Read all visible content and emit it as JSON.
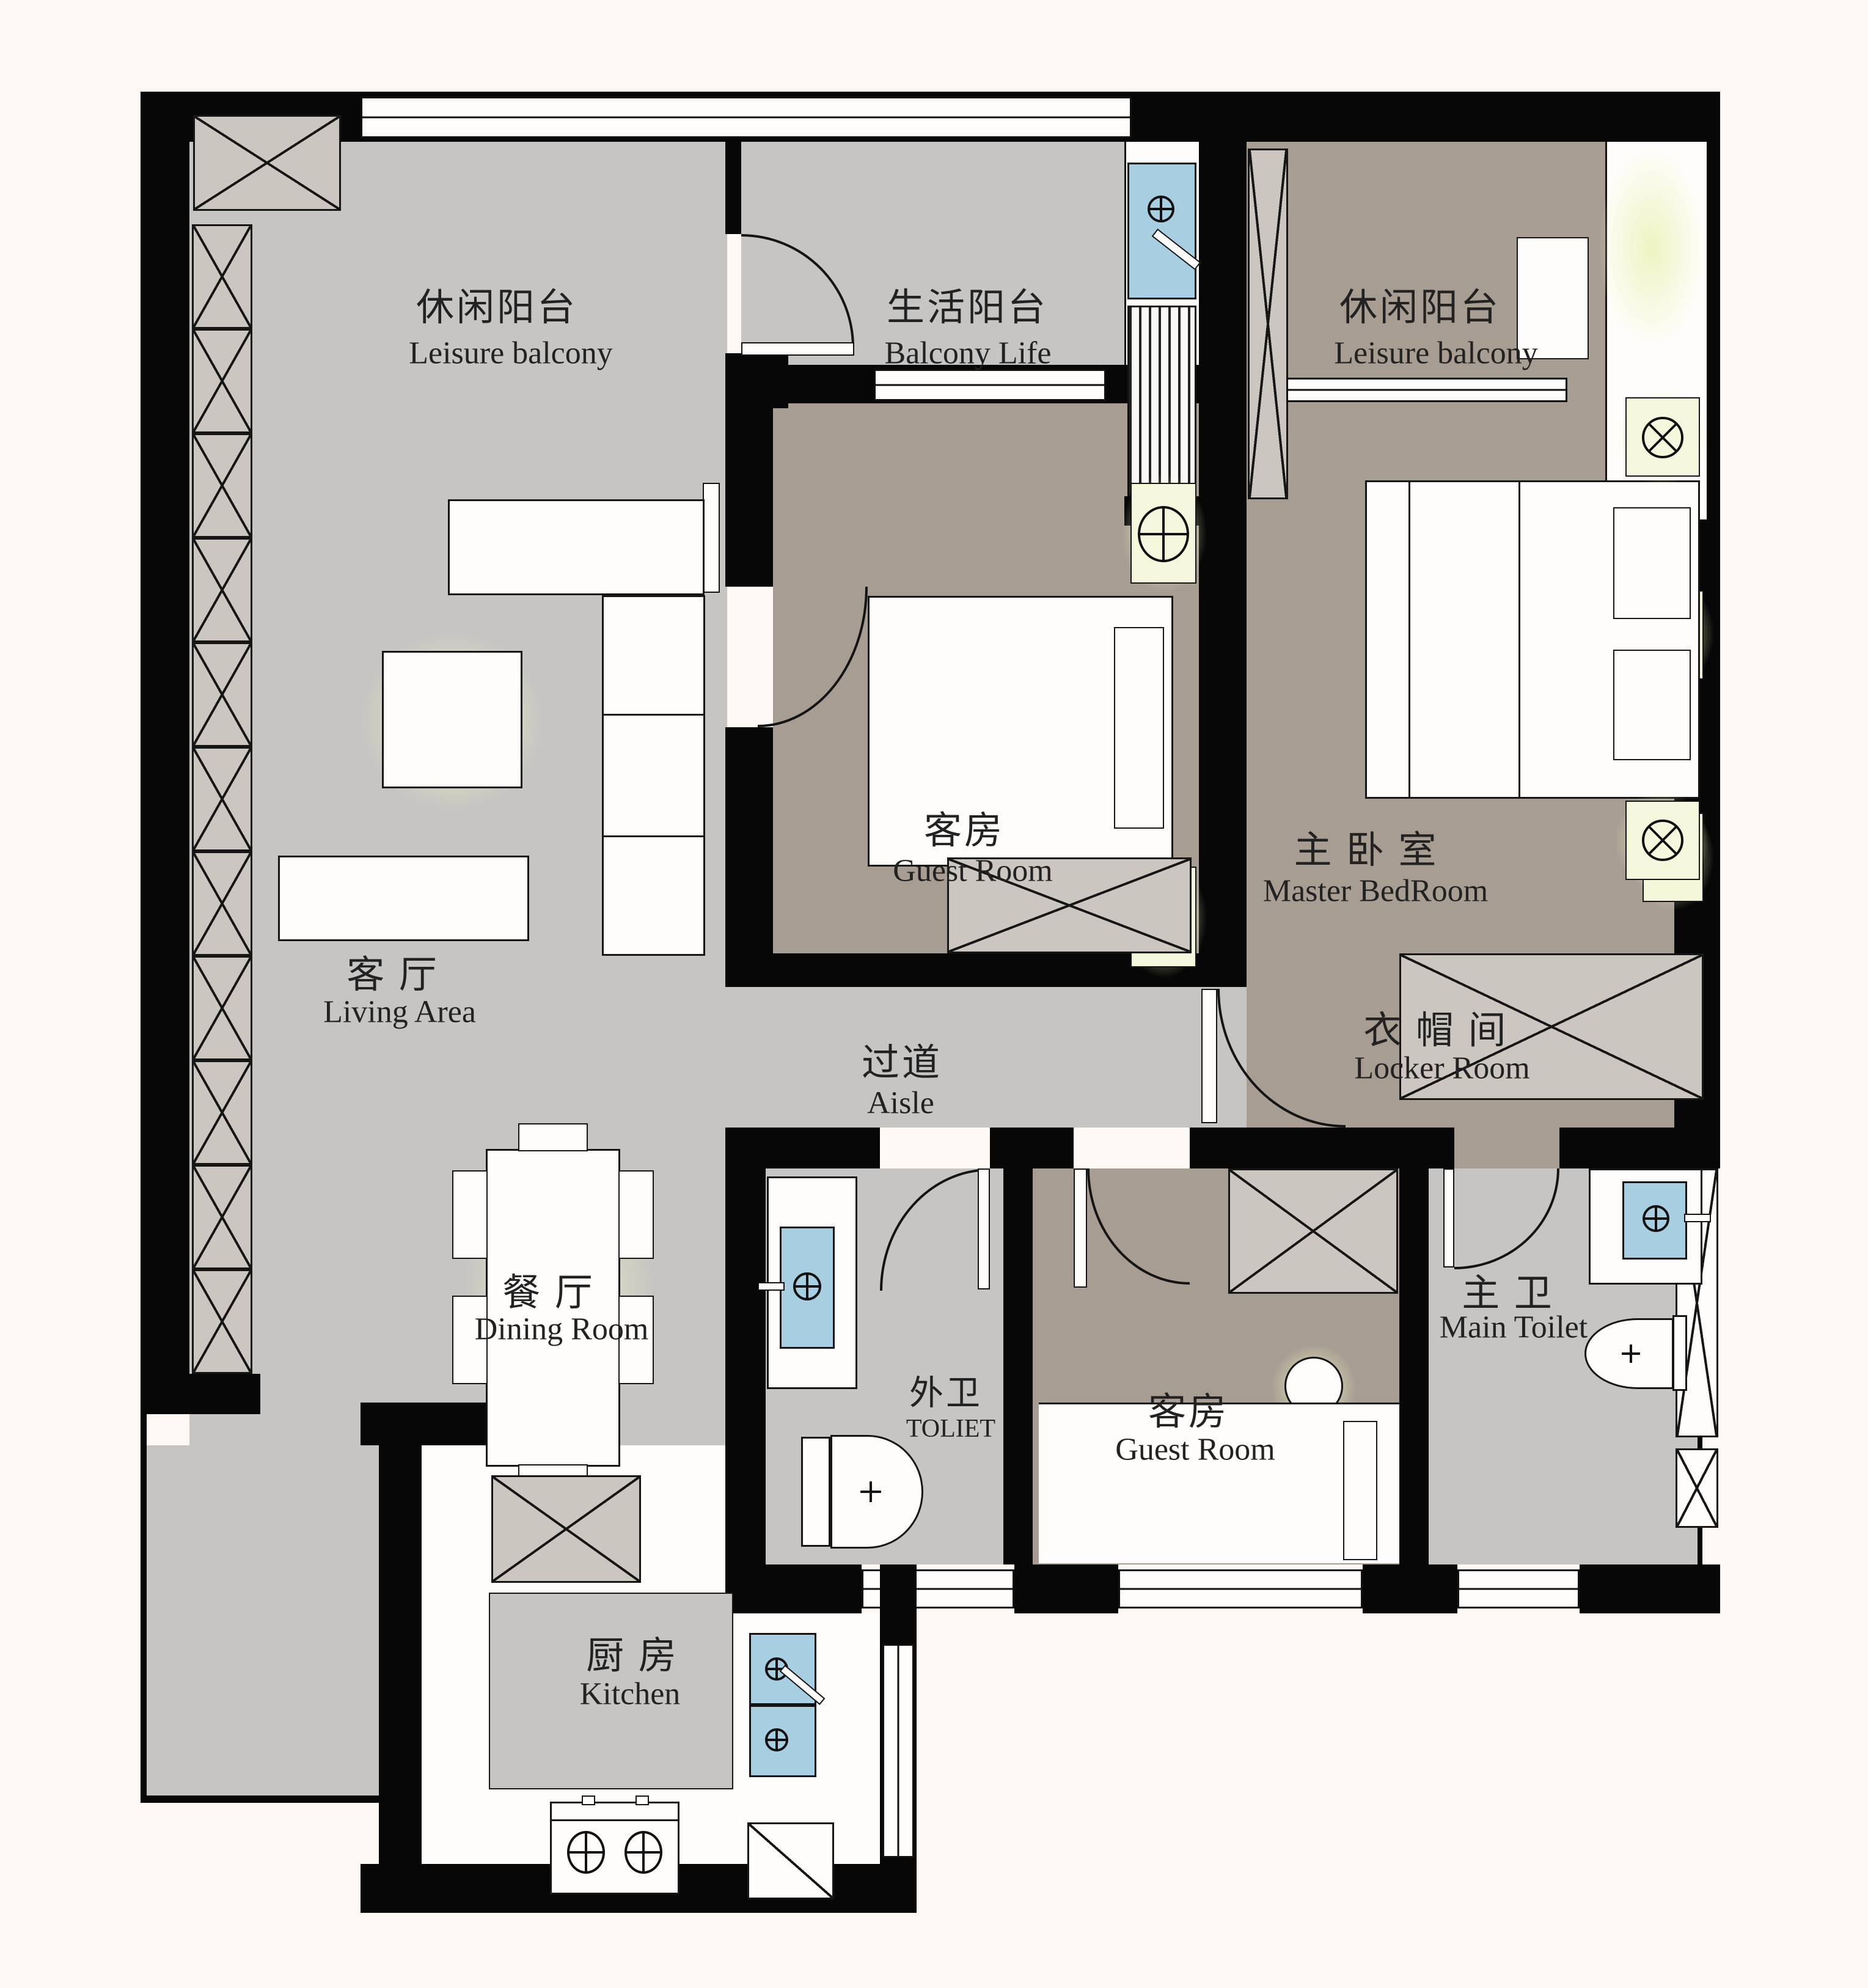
{
  "rooms": [
    {
      "id": "leisure_left",
      "zh": "休闲阳台",
      "en": "Leisure balcony"
    },
    {
      "id": "balcony_life",
      "zh": "生活阳台",
      "en": "Balcony Life"
    },
    {
      "id": "leisure_right",
      "zh": "休闲阳台",
      "en": "Leisure balcony"
    },
    {
      "id": "guest1",
      "zh": "客房",
      "en": "Guest Room"
    },
    {
      "id": "master",
      "zh": "主 卧 室",
      "en": "Master BedRoom"
    },
    {
      "id": "living",
      "zh": "客 厅",
      "en": "Living Area"
    },
    {
      "id": "aisle",
      "zh": "过道",
      "en": "Aisle"
    },
    {
      "id": "locker",
      "zh": "衣 帽 间",
      "en": "Locker Room"
    },
    {
      "id": "dining",
      "zh": "餐 厅",
      "en": "Dining Room"
    },
    {
      "id": "toilet",
      "zh": "外卫",
      "en": "TOLIET"
    },
    {
      "id": "guest2",
      "zh": "客房",
      "en": "Guest Room"
    },
    {
      "id": "main_toilet",
      "zh": "主 卫",
      "en": "Main Toilet"
    },
    {
      "id": "kitchen",
      "zh": "厨 房",
      "en": "Kitchen"
    }
  ],
  "colors": {
    "wall": "#070707",
    "floor_gray": "#c6c5c3",
    "floor_tan": "#a89d93",
    "fixture_blue": "#a7cfe1",
    "glow_green": "#edf3be",
    "background": "#fdf8f3"
  }
}
